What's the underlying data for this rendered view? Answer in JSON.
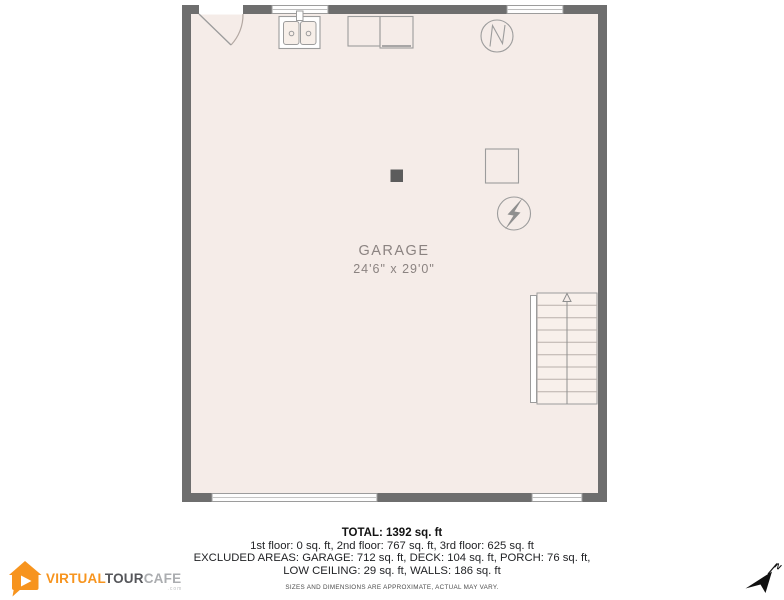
{
  "floor_plan": {
    "room": {
      "name": "GARAGE",
      "dimensions": "24'6\" x 29'0\""
    },
    "stairs_direction": "up",
    "colors": {
      "wall_gray": "#6e6e6e",
      "floor_fill": "#f5ece8",
      "fixture_outline": "#9c9c9c",
      "label_gray": "#8b8381",
      "accent_orange": "#f7941e"
    },
    "icons": {
      "door": "door-swing-arc",
      "sink": "double-basin-laundry-sink",
      "washer": "appliance-box",
      "dryer": "appliance-box",
      "water_heater": "circle-with-zigzag",
      "furnace": "outlined-square",
      "electrical": "circle-with-lightning-bolt",
      "support_post": "filled-square",
      "stairs": "staircase-with-up-arrow"
    }
  },
  "summary": {
    "total": "TOTAL: 1392 sq. ft",
    "floors": "1st floor: 0 sq. ft, 2nd floor: 767 sq. ft, 3rd floor: 625 sq. ft",
    "excluded_line1": "EXCLUDED AREAS: GARAGE: 712 sq. ft, DECK: 104 sq. ft, PORCH: 76 sq. ft,",
    "excluded_line2": "LOW CEILING: 29 sq. ft, WALLS: 186 sq. ft",
    "disclaimer": "SIZES AND DIMENSIONS ARE APPROXIMATE, ACTUAL MAY VARY."
  },
  "branding": {
    "logo_part1": "VIRTUAL",
    "logo_part2": "TOUR",
    "logo_part3": "CAFE",
    "logo_suffix": ".com"
  },
  "compass": {
    "north_label": "N"
  }
}
